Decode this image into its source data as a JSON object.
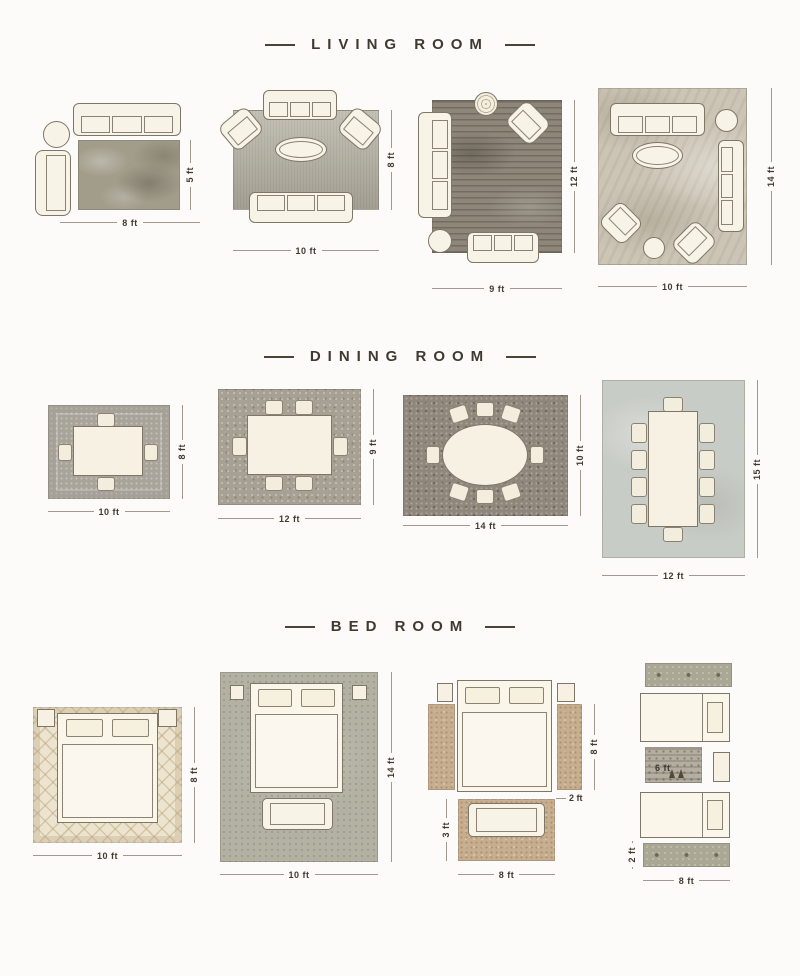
{
  "colors": {
    "background": "#fcfbf9",
    "title": "#3f3a31",
    "furniture_outline": "#7e7666",
    "furniture_fill": "#f8f3e7",
    "dimension_text": "#403a2f"
  },
  "sections": [
    {
      "title": "LIVING ROOM",
      "layouts": [
        {
          "name": "sofa-armchair",
          "w": "8 ft",
          "h": "5 ft"
        },
        {
          "name": "two-sofas-two-armchairs",
          "w": "10 ft",
          "h": "8 ft"
        },
        {
          "name": "two-sofas-armchair",
          "w": "9 ft",
          "h": "12 ft"
        },
        {
          "name": "three-sofas-two-armchairs",
          "w": "10 ft",
          "h": "14 ft"
        }
      ]
    },
    {
      "title": "DINING ROOM",
      "layouts": [
        {
          "name": "table-4-chairs",
          "w": "10 ft",
          "h": "8 ft"
        },
        {
          "name": "table-6-chairs",
          "w": "12 ft",
          "h": "9 ft"
        },
        {
          "name": "oval-table-8-chairs",
          "w": "14 ft",
          "h": "10 ft"
        },
        {
          "name": "long-table-10-chairs",
          "w": "12 ft",
          "h": "15 ft"
        }
      ]
    },
    {
      "title": "BED ROOM",
      "layouts": [
        {
          "name": "bed-full-rug",
          "w": "10 ft",
          "h": "8 ft"
        },
        {
          "name": "bed-bench-large-rug",
          "w": "10 ft",
          "h": "14 ft"
        },
        {
          "name": "bed-side-runners-foot-rug",
          "w": "8 ft",
          "h": "8 ft",
          "runner_w": "2 ft",
          "foot_h": "3 ft"
        },
        {
          "name": "twin-beds-runners",
          "w": "8 ft",
          "runner_h": "2 ft",
          "mid_w": "6 ft"
        }
      ]
    }
  ]
}
